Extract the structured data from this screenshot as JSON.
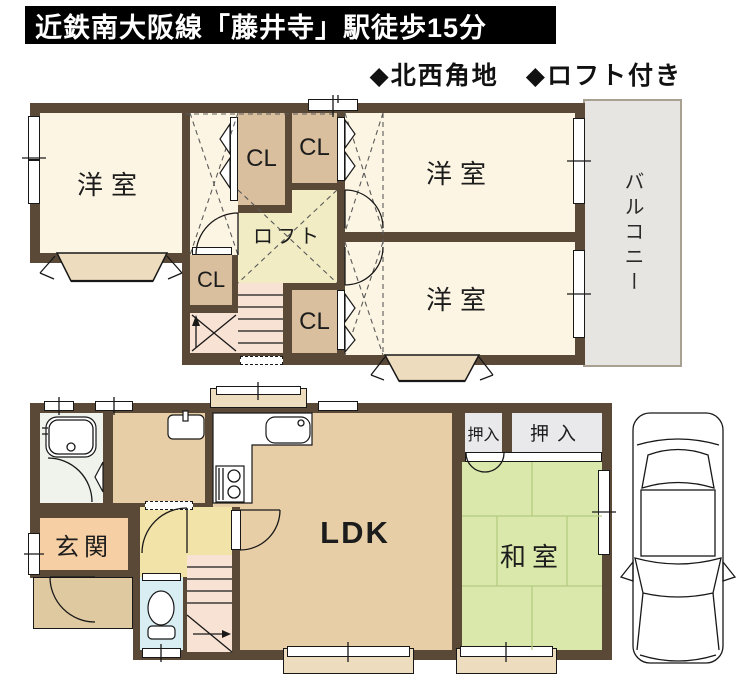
{
  "header": {
    "banner": "近鉄南大阪線「藤井寺」駅徒歩15分",
    "features": "◆北西角地　◆ロフト付き"
  },
  "floor2": {
    "western_room": "洋室",
    "closet": "CL",
    "loft": "ロフト",
    "balcony": "バルコニー"
  },
  "floor1": {
    "ldk": "LDK",
    "japanese_room": "和室",
    "oshiire": "押入",
    "entrance": "玄関"
  },
  "colors": {
    "wall": "#5a4937",
    "line": "#181818",
    "room-cream": "#fdf5e3",
    "closet-tan": "#d9bf9e",
    "loft-yellow": "#f1ecc3",
    "stairs-pink": "#f8e2d3",
    "balcony-gray": "#e6e5e2",
    "ldk-tan": "#e8cea7",
    "tatami-green": "#dbe8ab",
    "tatami-line": "#b4cc82",
    "oshiire-gray": "#e9e9ec",
    "entrance-peach": "#f6cfa5",
    "hall-yellow": "#f2e3a8",
    "porch-tan": "#dfc9a0",
    "toilet-blue": "#d8eef3",
    "bath-white": "#eff3ec",
    "bay-tan": "#eedcbf"
  }
}
